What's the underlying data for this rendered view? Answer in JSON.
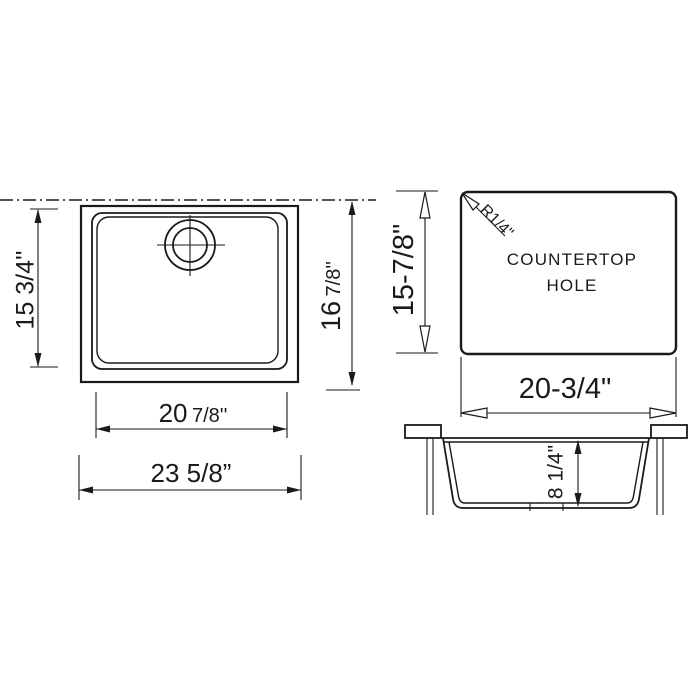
{
  "views": {
    "top": {
      "dim_inner_height": "15 3/4''",
      "dim_outer_height_main": "16",
      "dim_outer_height_frac": "7/8''",
      "dim_inner_width_main": "20",
      "dim_inner_width_frac": "7/8''",
      "dim_outer_width": "23 5/8”"
    },
    "countertop": {
      "line1": "COUNTERTOP",
      "line2": "HOLE",
      "corner_radius": "R1/4\"",
      "dim_height": "15-7/8\"",
      "dim_width": "20-3/4\""
    },
    "section": {
      "dim_depth": "8 1/4\""
    }
  },
  "colors": {
    "line": "#1a1a1a",
    "background": "#ffffff"
  }
}
